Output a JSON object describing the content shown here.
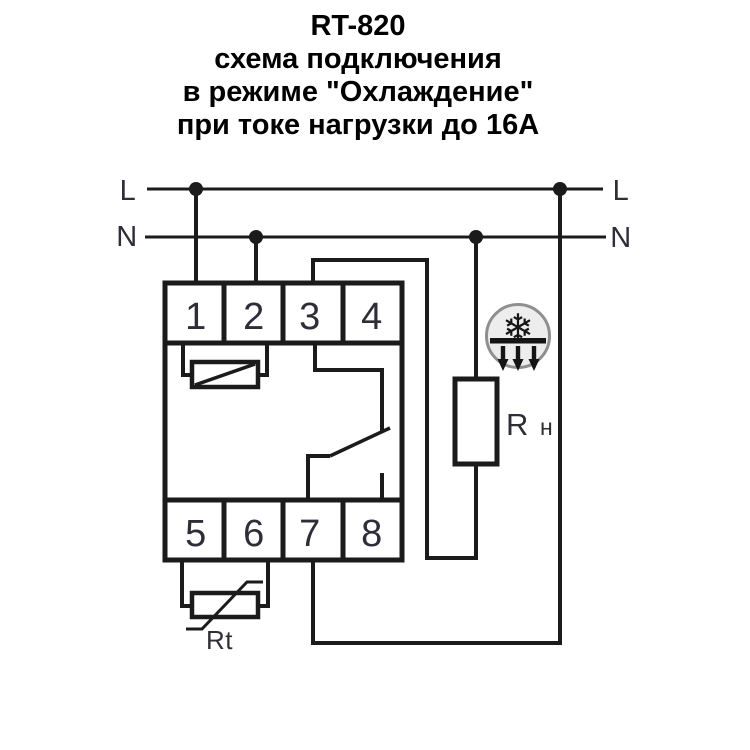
{
  "title": {
    "line1": "RT-820",
    "line2": "схема подключения",
    "line3": "в режиме \"Охлаждение\"",
    "line4": "при токе нагрузки до 16А"
  },
  "power": {
    "line_left": "L",
    "neutral_left": "N",
    "line_right": "L",
    "neutral_right": "N"
  },
  "terminals": {
    "top": [
      "1",
      "2",
      "3",
      "4"
    ],
    "bottom": [
      "5",
      "6",
      "7",
      "8"
    ]
  },
  "components": {
    "load_label": "R",
    "load_label_sub": "н",
    "sensor_label": "Rt"
  },
  "icon": {
    "name": "snowflake-cooling-icon",
    "glyph": "❄"
  },
  "colors": {
    "wire": "#1b1b1b",
    "text": "#2e2e38",
    "icon_glyph": "#151515",
    "icon_fill": "#ededed",
    "icon_ring": "#8f8f8f"
  }
}
